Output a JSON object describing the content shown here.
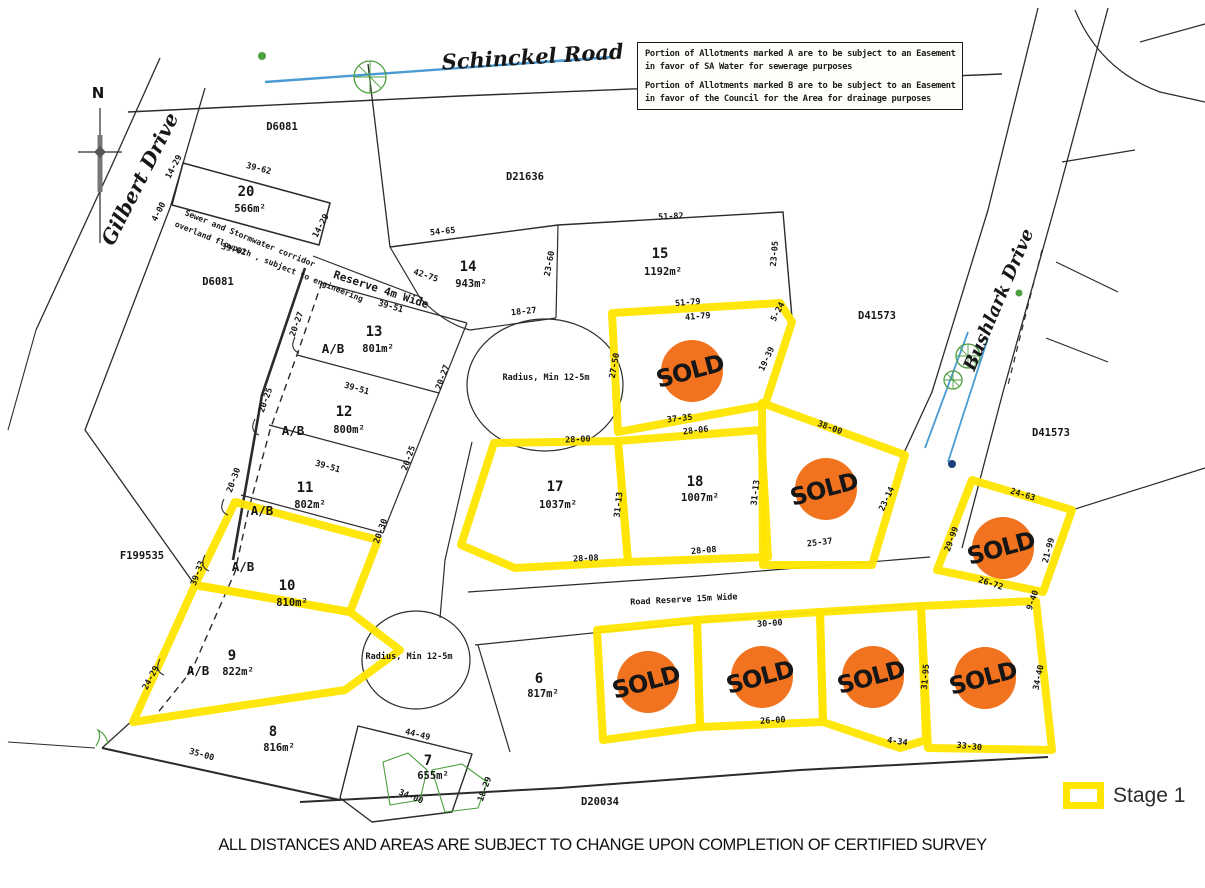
{
  "compass": {
    "n": "N"
  },
  "notes": {
    "line1": "Portion of Allotments marked A are to be subject to an Easement",
    "line2": "in favor of SA Water for sewerage purposes",
    "line3": "Portion of Allotments marked B are to be subject to an Easement",
    "line4": "in favor of the Council for the Area for drainage purposes"
  },
  "caption": "ALL DISTANCES AND AREAS ARE SUBJECT TO CHANGE UPON COMPLETION OF CERTIFIED SURVEY",
  "legend": {
    "label": "Stage 1"
  },
  "sold": {
    "label": "SOLD"
  },
  "colors": {
    "stage_yellow": "#ffe500",
    "sold_orange": "#f1731f",
    "sold_navy": "#1c3f78",
    "water_blue": "#4a9bd4",
    "tree_green": "#4d9e3f",
    "line_black": "#2b2b2b"
  },
  "roads": [
    {
      "t": "Schinckel Road",
      "x": 533,
      "y": 64,
      "r": -3.5,
      "s": 21
    },
    {
      "t": "Gilbert Drive",
      "x": 146,
      "y": 182,
      "r": -63,
      "s": 20
    },
    {
      "t": "Bushlark Drive",
      "x": 1004,
      "y": 302,
      "r": -67,
      "s": 18
    }
  ],
  "plan_refs": [
    {
      "t": "D6081",
      "x": 282,
      "y": 130
    },
    {
      "t": "D6081",
      "x": 218,
      "y": 285
    },
    {
      "t": "D21636",
      "x": 525,
      "y": 180
    },
    {
      "t": "D41573",
      "x": 877,
      "y": 319
    },
    {
      "t": "D41573",
      "x": 1051,
      "y": 436
    },
    {
      "t": "F199535",
      "x": 142,
      "y": 559
    },
    {
      "t": "D20034",
      "x": 600,
      "y": 805
    }
  ],
  "annotations": [
    {
      "t": "Reserve 4m Wide",
      "x": 380,
      "y": 293,
      "r": 18,
      "s": 11
    },
    {
      "t": "Sewer and Stormwater corridor",
      "x": 249,
      "y": 241,
      "r": 22,
      "s": 8
    },
    {
      "t": "overland flowpath , subject to engineering",
      "x": 268,
      "y": 264,
      "r": 22,
      "s": 8
    },
    {
      "t": "Radius, Min 12-5m",
      "x": 546,
      "y": 380,
      "r": 0,
      "s": 8.5
    },
    {
      "t": "Radius, Min 12-5m",
      "x": 409,
      "y": 659,
      "r": 0,
      "s": 8.5
    },
    {
      "t": "Road Reserve 15m Wide",
      "x": 684,
      "y": 602,
      "r": -3,
      "s": 8.5
    }
  ],
  "ab": {
    "t": "A/B",
    "points": [
      {
        "x": 333,
        "y": 353
      },
      {
        "x": 293,
        "y": 435
      },
      {
        "x": 262,
        "y": 515
      },
      {
        "x": 243,
        "y": 571
      },
      {
        "x": 198,
        "y": 675
      }
    ]
  },
  "lots": [
    {
      "num": "20",
      "area": "566m²",
      "nx": 246,
      "ny": 196,
      "ax": 250,
      "ay": 212
    },
    {
      "num": "14",
      "area": "943m²",
      "nx": 468,
      "ny": 271,
      "ax": 471,
      "ay": 287
    },
    {
      "num": "15",
      "area": "1192m²",
      "nx": 660,
      "ny": 258,
      "ax": 663,
      "ay": 275
    },
    {
      "num": "13",
      "area": "801m²",
      "nx": 374,
      "ny": 336,
      "ax": 378,
      "ay": 352
    },
    {
      "num": "12",
      "area": "800m²",
      "nx": 344,
      "ny": 416,
      "ax": 349,
      "ay": 433
    },
    {
      "num": "11",
      "area": "802m²",
      "nx": 305,
      "ny": 492,
      "ax": 310,
      "ay": 508
    },
    {
      "num": "10",
      "area": "810m²",
      "nx": 287,
      "ny": 590,
      "ax": 292,
      "ay": 606
    },
    {
      "num": "9",
      "area": "822m²",
      "nx": 232,
      "ny": 660,
      "ax": 238,
      "ay": 675
    },
    {
      "num": "8",
      "area": "816m²",
      "nx": 273,
      "ny": 736,
      "ax": 279,
      "ay": 751
    },
    {
      "num": "7",
      "area": "655m²",
      "nx": 428,
      "ny": 765,
      "ax": 433,
      "ay": 779
    },
    {
      "num": "6",
      "area": "817m²",
      "nx": 539,
      "ny": 683,
      "ax": 543,
      "ay": 697
    },
    {
      "num": "17",
      "area": "1037m²",
      "nx": 555,
      "ny": 491,
      "ax": 558,
      "ay": 508
    },
    {
      "num": "18",
      "area": "1007m²",
      "nx": 695,
      "ny": 486,
      "ax": 700,
      "ay": 501
    }
  ],
  "sold_circles": [
    {
      "x": 692,
      "y": 371
    },
    {
      "x": 826,
      "y": 489
    },
    {
      "x": 1003,
      "y": 548
    },
    {
      "x": 648,
      "y": 682
    },
    {
      "x": 762,
      "y": 677
    },
    {
      "x": 873,
      "y": 677
    },
    {
      "x": 985,
      "y": 678
    }
  ],
  "dims": [
    {
      "t": "14-29",
      "x": 176,
      "y": 168,
      "r": -62
    },
    {
      "t": "39-62",
      "x": 258,
      "y": 171,
      "r": 15
    },
    {
      "t": "14-29",
      "x": 323,
      "y": 227,
      "r": -62
    },
    {
      "t": "4-00",
      "x": 161,
      "y": 213,
      "r": -62
    },
    {
      "t": "39-62",
      "x": 233,
      "y": 252,
      "r": 15
    },
    {
      "t": "54-65",
      "x": 443,
      "y": 234,
      "r": -6
    },
    {
      "t": "42-75",
      "x": 425,
      "y": 278,
      "r": 18
    },
    {
      "t": "39-51",
      "x": 390,
      "y": 309,
      "r": 16
    },
    {
      "t": "23-60",
      "x": 552,
      "y": 264,
      "r": -80
    },
    {
      "t": "51-82",
      "x": 671,
      "y": 219,
      "r": -3
    },
    {
      "t": "23-05",
      "x": 777,
      "y": 254,
      "r": -85
    },
    {
      "t": "18-27",
      "x": 524,
      "y": 314,
      "r": -6
    },
    {
      "t": "20-27",
      "x": 299,
      "y": 325,
      "r": -70
    },
    {
      "t": "20-27",
      "x": 445,
      "y": 378,
      "r": -70
    },
    {
      "t": "39-51",
      "x": 356,
      "y": 391,
      "r": 16
    },
    {
      "t": "20-25",
      "x": 268,
      "y": 401,
      "r": -70
    },
    {
      "t": "20-25",
      "x": 411,
      "y": 459,
      "r": -70
    },
    {
      "t": "39-51",
      "x": 327,
      "y": 469,
      "r": 16
    },
    {
      "t": "20-30",
      "x": 236,
      "y": 481,
      "r": -70
    },
    {
      "t": "20-30",
      "x": 383,
      "y": 532,
      "r": -70
    },
    {
      "t": "39-33",
      "x": 200,
      "y": 574,
      "r": -70
    },
    {
      "t": "24-29",
      "x": 153,
      "y": 679,
      "r": -62
    },
    {
      "t": "35-00",
      "x": 201,
      "y": 757,
      "r": 16
    },
    {
      "t": "44-49",
      "x": 417,
      "y": 737,
      "r": 14
    },
    {
      "t": "34-00",
      "x": 410,
      "y": 799,
      "r": 22
    },
    {
      "t": "18-29",
      "x": 487,
      "y": 790,
      "r": -70
    },
    {
      "t": "51-79",
      "x": 688,
      "y": 305,
      "r": -5
    },
    {
      "t": "41-79",
      "x": 698,
      "y": 319,
      "r": -5
    },
    {
      "t": "5-24",
      "x": 780,
      "y": 313,
      "r": -62
    },
    {
      "t": "27-50",
      "x": 617,
      "y": 366,
      "r": -80
    },
    {
      "t": "19-39",
      "x": 769,
      "y": 360,
      "r": -65
    },
    {
      "t": "37-35",
      "x": 680,
      "y": 421,
      "r": -7
    },
    {
      "t": "28-06",
      "x": 696,
      "y": 433,
      "r": -7
    },
    {
      "t": "28-00",
      "x": 578,
      "y": 442,
      "r": -3
    },
    {
      "t": "28-08",
      "x": 586,
      "y": 561,
      "r": -3
    },
    {
      "t": "31-13",
      "x": 621,
      "y": 505,
      "r": -83
    },
    {
      "t": "31-13",
      "x": 758,
      "y": 493,
      "r": -83
    },
    {
      "t": "28-08",
      "x": 704,
      "y": 553,
      "r": -5
    },
    {
      "t": "38-00",
      "x": 829,
      "y": 430,
      "r": 20
    },
    {
      "t": "23-14",
      "x": 889,
      "y": 500,
      "r": -65
    },
    {
      "t": "25-37",
      "x": 820,
      "y": 545,
      "r": -7
    },
    {
      "t": "24-63",
      "x": 1022,
      "y": 497,
      "r": 17
    },
    {
      "t": "29-99",
      "x": 954,
      "y": 540,
      "r": -70
    },
    {
      "t": "21-99",
      "x": 1051,
      "y": 551,
      "r": -75
    },
    {
      "t": "26-72",
      "x": 990,
      "y": 586,
      "r": 18
    },
    {
      "t": "9-40",
      "x": 1035,
      "y": 601,
      "r": -70
    },
    {
      "t": "30-00",
      "x": 770,
      "y": 626,
      "r": -4
    },
    {
      "t": "26-00",
      "x": 773,
      "y": 723,
      "r": -4
    },
    {
      "t": "4-34",
      "x": 897,
      "y": 744,
      "r": 8
    },
    {
      "t": "31-95",
      "x": 928,
      "y": 677,
      "r": -85
    },
    {
      "t": "33-30",
      "x": 969,
      "y": 749,
      "r": 6
    },
    {
      "t": "34-40",
      "x": 1041,
      "y": 678,
      "r": -78
    }
  ]
}
